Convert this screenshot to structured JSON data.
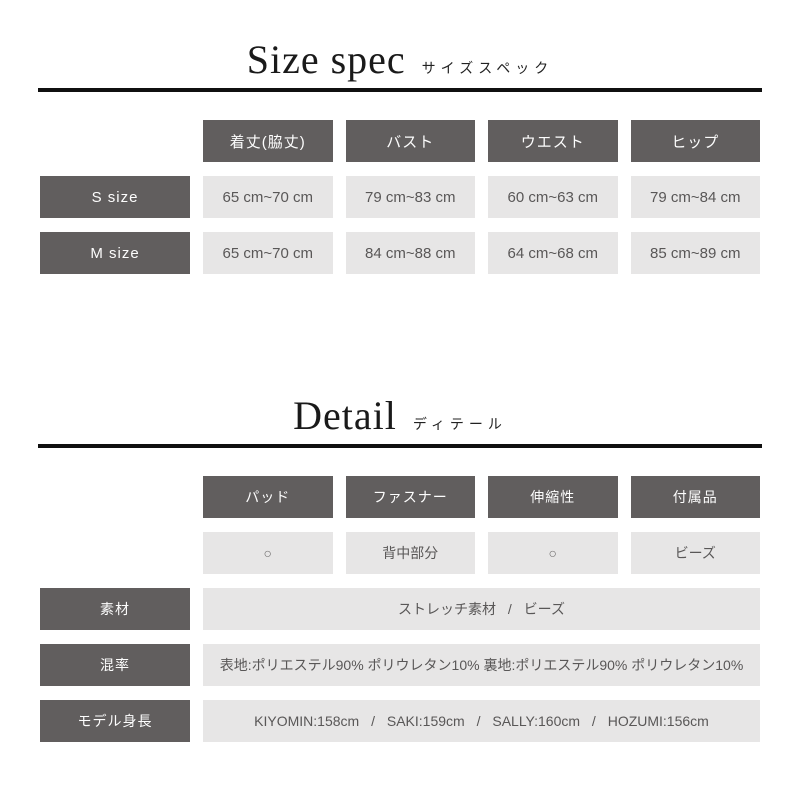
{
  "size_spec": {
    "title_en": "Size spec",
    "title_ja": "サイズスペック",
    "columns": [
      "着丈(脇丈)",
      "バスト",
      "ウエスト",
      "ヒップ"
    ],
    "rows": [
      {
        "label": "S size",
        "values": [
          "65 cm~70 cm",
          "79 cm~83 cm",
          "60 cm~63 cm",
          "79 cm~84 cm"
        ]
      },
      {
        "label": "M size",
        "values": [
          "65 cm~70 cm",
          "84 cm~88 cm",
          "64 cm~68 cm",
          "85 cm~89 cm"
        ]
      }
    ]
  },
  "detail": {
    "title_en": "Detail",
    "title_ja": "ディテール",
    "columns": [
      "パッド",
      "ファスナー",
      "伸縮性",
      "付属品"
    ],
    "values": [
      "○",
      "背中部分",
      "○",
      "ビーズ"
    ],
    "info_rows": [
      {
        "label": "素材",
        "value": "ストレッチ素材 / ビーズ"
      },
      {
        "label": "混率",
        "value": "表地:ポリエステル90% ポリウレタン10% 裏地:ポリエステル90% ポリウレタン10%"
      },
      {
        "label": "モデル身長",
        "value": "KIYOMIN:158cm / SAKI:159cm / SALLY:160cm / HOZUMI:156cm"
      }
    ]
  },
  "colors": {
    "header_bg": "#615e5e",
    "cell_bg": "#e7e6e6",
    "header_text": "#fdfdfd",
    "cell_text": "#595757",
    "divider": "#101010",
    "title_text": "#1a1a1a"
  }
}
